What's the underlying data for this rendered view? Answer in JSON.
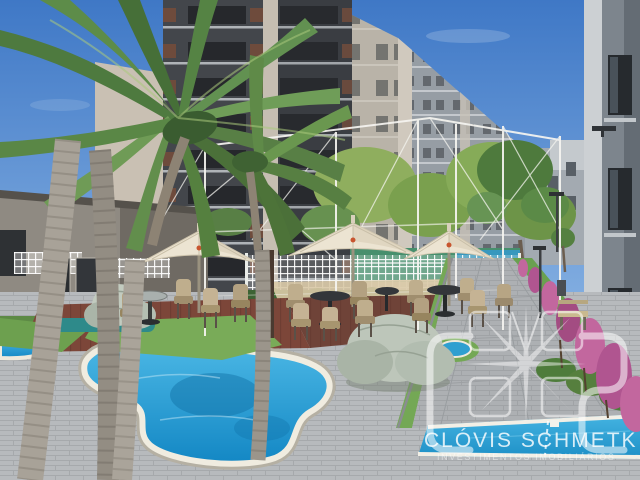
{
  "description": "Architectural rendering of a residential condominium leisure area: free-form pool, palm trees, patio umbrellas with wicker dining sets inside a white pergola frame, apartment towers behind, paved walkway with flowering hedge on the right, developer watermark overlay",
  "watermark": {
    "monogram": "CMS",
    "brand": "CLÓVIS SCHMETK",
    "tagline": "INVESTIMENTOS IMOBILIÁRIOS"
  },
  "palette": {
    "sky_top": "#3f78c6",
    "sky_bottom": "#a9cdf0",
    "pool_water": "#1a9ad6",
    "lap_pool_water": "#2aa3da",
    "pool_curb_white": "#f0ece0",
    "pool_stone_edge": "#b5b0a3",
    "umbrella_canopy": "#ece4d2",
    "pergola_white": "#f6f5f1",
    "deck_brown": "#7c4639",
    "paver_gray": "#b7babd",
    "building_dark": "#43464b",
    "building_light": "#b9b3a8",
    "right_building_gray": "#7d858d",
    "grass_green": "#79ab58",
    "palm_green": "#5d8549",
    "flower_pink": "#c2679e",
    "wicker_tan": "#bfae8d",
    "court_green": "#478f6d",
    "watermark_white": "rgba(255,255,255,0.8)"
  },
  "scene": {
    "elements": [
      "apartment-towers",
      "clubhouse",
      "royal-palm-tree",
      "background-palms",
      "white-pergola-frame",
      "patio-umbrellas",
      "wicker-dining-sets",
      "lattice-fence",
      "sport-court",
      "ornamental-rocks",
      "free-form-pool",
      "lap-pool",
      "garden-walkway",
      "flower-hedge",
      "garden-bench",
      "garden-lamps",
      "right-apartment-building"
    ]
  }
}
